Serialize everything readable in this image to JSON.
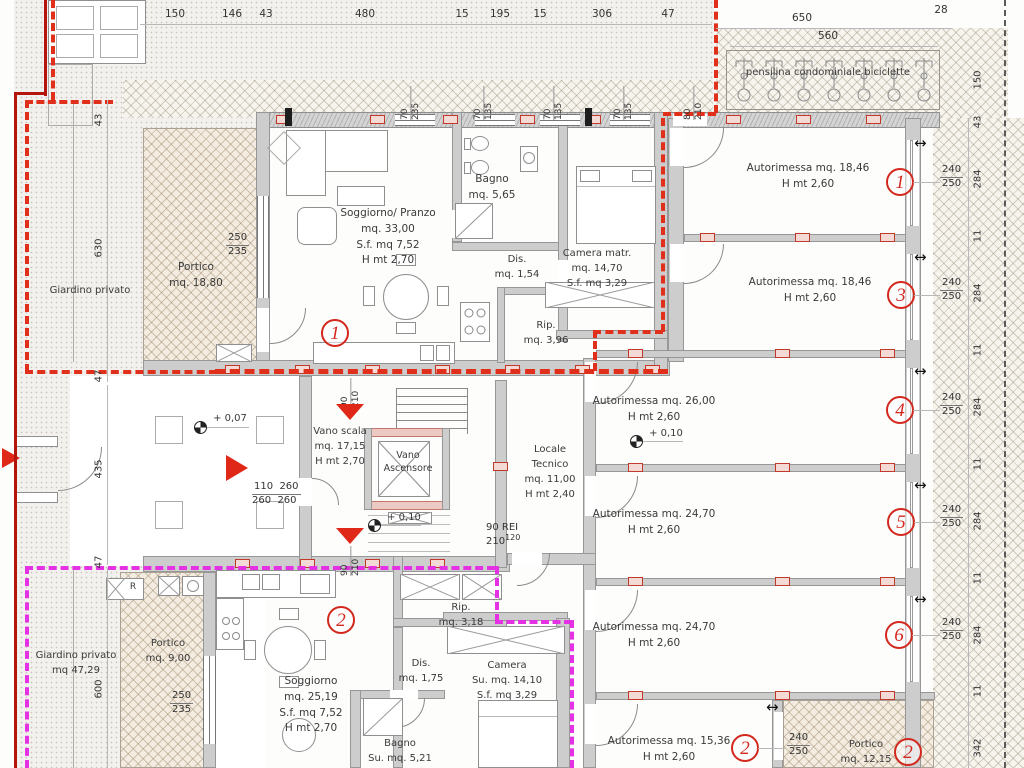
{
  "colors": {
    "boundary_unit1": "#e0301c",
    "boundary_unit2": "#e431e4",
    "accent_red": "#d2281e",
    "wall_gray": "#cdcdcd"
  },
  "top_dims": [
    "150",
    "146",
    "43",
    "480",
    "15",
    "195",
    "15",
    "306",
    "47"
  ],
  "pensilina": {
    "label": "pensilina condominiale biciclette",
    "d650": "650",
    "d560": "560",
    "d28": "28"
  },
  "right_dims": [
    "150",
    "43",
    "284",
    "11",
    "284",
    "11",
    "284",
    "11",
    "284",
    "11",
    "284",
    "11",
    "342"
  ],
  "left_dims": [
    "43",
    "630",
    "47",
    "435",
    "47",
    "600"
  ],
  "win_dims": [
    [
      "70",
      "235"
    ],
    [
      "70",
      "135"
    ],
    [
      "70",
      "135"
    ],
    [
      "70",
      "135"
    ],
    [
      "80",
      "210"
    ]
  ],
  "stair_doors": {
    "top": [
      "90",
      "210"
    ],
    "bottom": [
      "90",
      "210"
    ]
  },
  "apt1": {
    "num": "1",
    "garden": "Giardino privato",
    "portico": [
      "Portico",
      "mq. 18,80"
    ],
    "window": [
      "250",
      "235"
    ],
    "soggiorno": [
      "Soggiorno/ Pranzo",
      "mq. 33,00",
      "S.f. mq 7,52",
      "H mt 2,70"
    ],
    "bagno": [
      "Bagno",
      "mq. 5,65"
    ],
    "dis": [
      "Dis.",
      "mq. 1,54"
    ],
    "rip": [
      "Rip.",
      "mq. 3,96"
    ],
    "camera": [
      "Camera matr.",
      "mq. 14,70",
      "S.f. mq 3,29"
    ],
    "entry_dims": [
      "110  260",
      "260  260"
    ],
    "lvl": "+ 0,07"
  },
  "apt2": {
    "num": "2",
    "garden": [
      "Giardino privato",
      "mq 47,29"
    ],
    "portico": [
      "Portico",
      "mq. 9,00"
    ],
    "window": [
      "250",
      "235"
    ],
    "soggiorno": [
      "Soggiorno",
      "mq. 25,19",
      "S.f. mq 7,52",
      "H mt 2,70"
    ],
    "rip": [
      "Rip.",
      "mq. 3,18"
    ],
    "dis": [
      "Dis.",
      "mq. 1,75"
    ],
    "camera": [
      "Camera",
      "Su. mq. 14,10",
      "S.f. mq 3,29"
    ],
    "bagno": [
      "Bagno",
      "Su. mq. 5,21"
    ],
    "r": "R"
  },
  "core": {
    "scala": [
      "Vano scala",
      "mq. 17,15",
      "H mt 2,70"
    ],
    "ascensore": [
      "Vano",
      "Ascensore"
    ],
    "locale_tecnico": [
      "Locale",
      "Tecnico",
      "mq. 11,00",
      "H mt 2,40"
    ],
    "lvl": "+ 0,10",
    "rei": [
      "90 REI",
      "210",
      "120"
    ]
  },
  "garages": {
    "lvl": "+ 0,10",
    "units": [
      {
        "name": "Autorimessa mq. 18,46",
        "h": "H mt 2,60",
        "num": "1",
        "d": [
          "240",
          "250"
        ]
      },
      {
        "name": "Autorimessa mq. 18,46",
        "h": "H mt 2,60",
        "num": "3",
        "d": [
          "240",
          "250"
        ]
      },
      {
        "name": "Autorimessa mq. 26,00",
        "h": "H mt 2,60",
        "num": "4",
        "d": [
          "240",
          "250"
        ]
      },
      {
        "name": "Autorimessa mq. 24,70",
        "h": "H mt 2,60",
        "num": "5",
        "d": [
          "240",
          "250"
        ]
      },
      {
        "name": "Autorimessa mq. 24,70",
        "h": "H mt 2,60",
        "num": "6",
        "d": [
          "240",
          "250"
        ]
      },
      {
        "name": "Autorimessa mq. 15,36",
        "h": "H mt 2,60",
        "num": "2",
        "d": [
          "240",
          "250"
        ]
      }
    ],
    "portico": [
      "Portico",
      "mq. 12,15"
    ],
    "portico_num": "2"
  },
  "icons": {
    "double_arrow": "↔"
  }
}
